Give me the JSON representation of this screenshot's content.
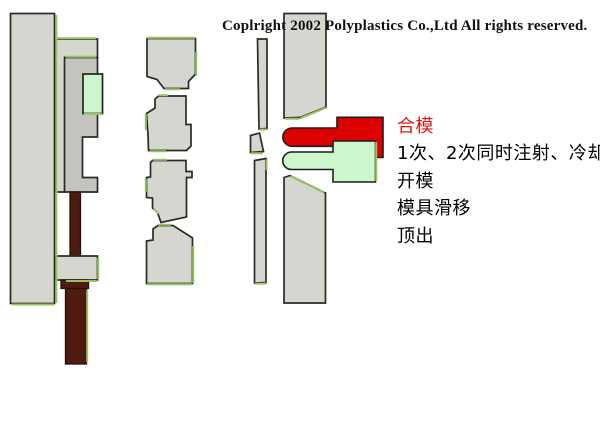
{
  "page": {
    "width": 600,
    "height": 430,
    "background": "#ffffff"
  },
  "copyright": "Coplright 2002 Polyplastics Co.,Ltd All rights reserved.",
  "process_steps": [
    {
      "label": "合模",
      "state": "highlighted"
    },
    {
      "label": "1次、2次同时注射、冷却",
      "state": "normal"
    },
    {
      "label": "开模",
      "state": "normal"
    },
    {
      "label": "模具滑移",
      "state": "normal"
    },
    {
      "label": "顶出",
      "state": "normal"
    }
  ],
  "colors": {
    "step_highlight_red": "#e01717",
    "molded_part_red": "#dd0000",
    "molded_part_green": "#ccf6cb",
    "mold_gray": "#d6d6d0",
    "mold_gray_dark": "#c4c4be",
    "edge_accent_green": "#97c45f",
    "rod_maroon": "#4f1b11",
    "outline": "#2b2b26",
    "text_black": "#000000"
  }
}
